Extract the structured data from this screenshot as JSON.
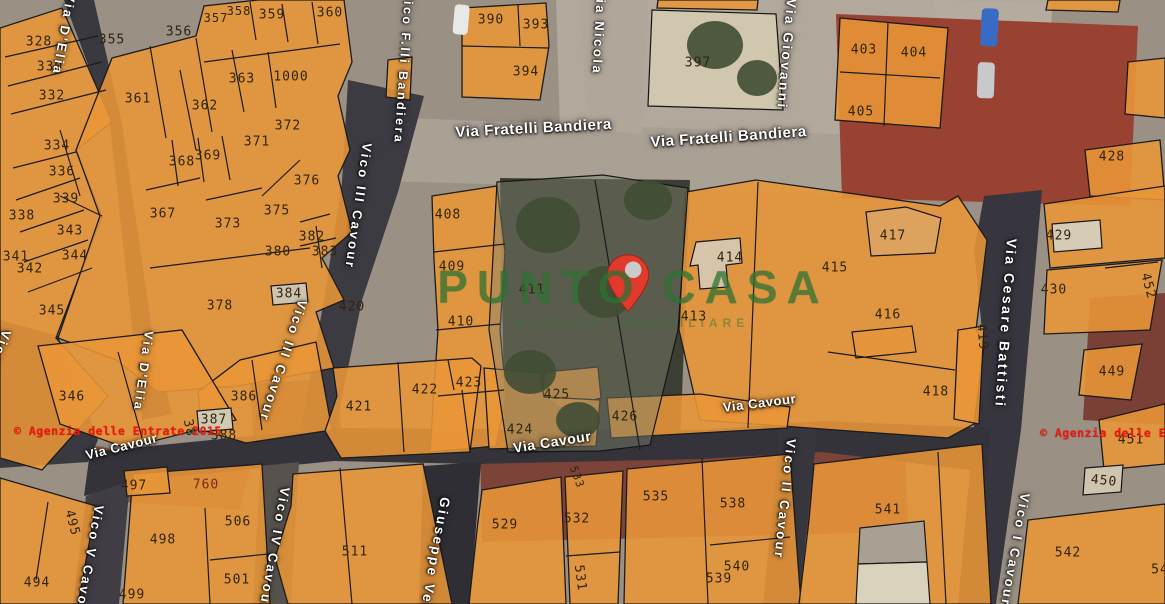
{
  "map": {
    "description": "satellite cadastral map with orange parcel overlay"
  },
  "watermark": {
    "line1": "PUNTO",
    "line2": "CASA",
    "subtitle": "AGENZIA IMMOBILIARE",
    "color": "#307434"
  },
  "marker": {
    "name": "property-location",
    "color": "#df3a2c"
  },
  "copyright_left": "© Agenzia delle Entrate 2015",
  "copyright_right": "© Agenzia delle En",
  "colors": {
    "parcel_fill": "#E99638",
    "parcel_line": "#1b1b1b",
    "street_dark": "#383741",
    "road_light": "#ABA194",
    "label_text": "#30250f",
    "street_text": "#ffffff",
    "copyright": "#f1170c"
  },
  "street_labels": [
    {
      "name": "Via D'Elia",
      "x": 64,
      "y": -8,
      "v": 1,
      "rot": 10,
      "fs": 13
    },
    {
      "name": "Vico F.lli Bandiera",
      "x": 402,
      "y": -10,
      "v": 1,
      "rot": 4,
      "fs": 12.5
    },
    {
      "name": "Via Nicola",
      "x": 594,
      "y": -12,
      "v": 1,
      "rot": 3,
      "fs": 13
    },
    {
      "name": "Via Giovanni",
      "x": 784,
      "y": -2,
      "v": 1,
      "rot": 5,
      "fs": 13.5
    },
    {
      "name": "Via Fratelli Bandiera",
      "x": 455,
      "y": 124,
      "v": 0,
      "rot": -3,
      "fs": 15
    },
    {
      "name": "Via Fratelli Bandiera",
      "x": 650,
      "y": 134,
      "v": 0,
      "rot": -4,
      "fs": 15
    },
    {
      "name": "Vico III Cavour",
      "x": 360,
      "y": 142,
      "v": 1,
      "rot": 8,
      "fs": 13
    },
    {
      "name": "Vico III Cavour",
      "x": 296,
      "y": 298,
      "v": 1,
      "rot": 18,
      "fs": 13
    },
    {
      "name": "Via D'Elia",
      "x": 142,
      "y": 330,
      "v": 1,
      "rot": 8,
      "fs": 12.5
    },
    {
      "name": "Vico VI Cavour",
      "x": 0,
      "y": 328,
      "v": 1,
      "rot": 20,
      "fs": 13
    },
    {
      "name": "Via Cesare Battisti",
      "x": 1004,
      "y": 238,
      "v": 1,
      "rot": 4,
      "fs": 14
    },
    {
      "name": "Via Cavour",
      "x": 84,
      "y": 448,
      "v": 0,
      "rot": -14,
      "fs": 13
    },
    {
      "name": "Via Cavour",
      "x": 512,
      "y": 440,
      "v": 0,
      "rot": -9,
      "fs": 14
    },
    {
      "name": "Via Cavour",
      "x": 722,
      "y": 400,
      "v": 0,
      "rot": -7,
      "fs": 13
    },
    {
      "name": "Vico V Cavour",
      "x": 92,
      "y": 504,
      "v": 1,
      "rot": 10,
      "fs": 13
    },
    {
      "name": "Vico IV Cavour",
      "x": 278,
      "y": 486,
      "v": 1,
      "rot": 10,
      "fs": 13
    },
    {
      "name": "Giuseppe Verdi",
      "x": 438,
      "y": 496,
      "v": 1,
      "rot": 10,
      "fs": 13.5
    },
    {
      "name": "Vico II Cavour",
      "x": 784,
      "y": 438,
      "v": 1,
      "rot": 6,
      "fs": 13
    },
    {
      "name": "Vico I Cavour",
      "x": 1018,
      "y": 492,
      "v": 1,
      "rot": 10,
      "fs": 13
    }
  ],
  "parcel_labels": [
    {
      "n": "328",
      "x": 39,
      "y": 42
    },
    {
      "n": "330",
      "x": 50,
      "y": 67
    },
    {
      "n": "332",
      "x": 52,
      "y": 96
    },
    {
      "n": "334",
      "x": 57,
      "y": 146
    },
    {
      "n": "336",
      "x": 62,
      "y": 172
    },
    {
      "n": "338",
      "x": 22,
      "y": 216
    },
    {
      "n": "339",
      "x": 66,
      "y": 199
    },
    {
      "n": "343",
      "x": 70,
      "y": 231
    },
    {
      "n": "341",
      "x": 16,
      "y": 257
    },
    {
      "n": "344",
      "x": 75,
      "y": 256
    },
    {
      "n": "342",
      "x": 30,
      "y": 269
    },
    {
      "n": "345",
      "x": 52,
      "y": 311
    },
    {
      "n": "346",
      "x": 72,
      "y": 397
    },
    {
      "n": "355",
      "x": 112,
      "y": 40
    },
    {
      "n": "356",
      "x": 179,
      "y": 32
    },
    {
      "n": "357",
      "x": 216,
      "y": 18,
      "fs": 12
    },
    {
      "n": "358",
      "x": 239,
      "y": 11,
      "fs": 12
    },
    {
      "n": "359",
      "x": 272,
      "y": 15
    },
    {
      "n": "360",
      "x": 330,
      "y": 13
    },
    {
      "n": "361",
      "x": 138,
      "y": 99
    },
    {
      "n": "362",
      "x": 205,
      "y": 106
    },
    {
      "n": "363",
      "x": 242,
      "y": 79
    },
    {
      "n": "1000",
      "x": 291,
      "y": 77
    },
    {
      "n": "372",
      "x": 288,
      "y": 126
    },
    {
      "n": "371",
      "x": 257,
      "y": 142
    },
    {
      "n": "368",
      "x": 182,
      "y": 162
    },
    {
      "n": "369",
      "x": 208,
      "y": 156
    },
    {
      "n": "367",
      "x": 163,
      "y": 214
    },
    {
      "n": "373",
      "x": 228,
      "y": 224
    },
    {
      "n": "375",
      "x": 277,
      "y": 211
    },
    {
      "n": "376",
      "x": 307,
      "y": 181
    },
    {
      "n": "380",
      "x": 278,
      "y": 252
    },
    {
      "n": "382",
      "x": 312,
      "y": 237
    },
    {
      "n": "383",
      "x": 325,
      "y": 252
    },
    {
      "n": "384",
      "x": 289,
      "y": 294
    },
    {
      "n": "378",
      "x": 220,
      "y": 306
    },
    {
      "n": "420",
      "x": 352,
      "y": 307
    },
    {
      "n": "386",
      "x": 244,
      "y": 397
    },
    {
      "n": "387",
      "x": 214,
      "y": 420
    },
    {
      "n": "388",
      "x": 224,
      "y": 436
    },
    {
      "n": "38",
      "x": 189,
      "y": 428,
      "rot": 78
    },
    {
      "n": "390",
      "x": 491,
      "y": 20
    },
    {
      "n": "393",
      "x": 536,
      "y": 25
    },
    {
      "n": "394",
      "x": 526,
      "y": 72
    },
    {
      "n": "397",
      "x": 698,
      "y": 63
    },
    {
      "n": "403",
      "x": 864,
      "y": 50
    },
    {
      "n": "404",
      "x": 914,
      "y": 53
    },
    {
      "n": "405",
      "x": 861,
      "y": 112
    },
    {
      "n": "428",
      "x": 1112,
      "y": 157
    },
    {
      "n": "408",
      "x": 448,
      "y": 215
    },
    {
      "n": "409",
      "x": 452,
      "y": 267
    },
    {
      "n": "410",
      "x": 461,
      "y": 322
    },
    {
      "n": "411",
      "x": 532,
      "y": 290
    },
    {
      "n": "413",
      "x": 694,
      "y": 317
    },
    {
      "n": "414",
      "x": 730,
      "y": 258
    },
    {
      "n": "415",
      "x": 835,
      "y": 268
    },
    {
      "n": "416",
      "x": 888,
      "y": 315
    },
    {
      "n": "417",
      "x": 893,
      "y": 236
    },
    {
      "n": "418",
      "x": 936,
      "y": 392
    },
    {
      "n": "419",
      "x": 982,
      "y": 337,
      "rot": 85
    },
    {
      "n": "429",
      "x": 1059,
      "y": 236
    },
    {
      "n": "430",
      "x": 1054,
      "y": 290
    },
    {
      "n": "449",
      "x": 1112,
      "y": 372
    },
    {
      "n": "452",
      "x": 1148,
      "y": 286,
      "rot": 75
    },
    {
      "n": "451",
      "x": 1131,
      "y": 440
    },
    {
      "n": "450",
      "x": 1104,
      "y": 481,
      "rot": 6
    },
    {
      "n": "421",
      "x": 359,
      "y": 407
    },
    {
      "n": "422",
      "x": 425,
      "y": 390
    },
    {
      "n": "423",
      "x": 469,
      "y": 383
    },
    {
      "n": "424",
      "x": 520,
      "y": 430
    },
    {
      "n": "425",
      "x": 557,
      "y": 395
    },
    {
      "n": "426",
      "x": 625,
      "y": 417
    },
    {
      "n": "494",
      "x": 37,
      "y": 583
    },
    {
      "n": "495",
      "x": 72,
      "y": 523,
      "rot": 75
    },
    {
      "n": "497",
      "x": 134,
      "y": 486
    },
    {
      "n": "498",
      "x": 163,
      "y": 540
    },
    {
      "n": "499",
      "x": 132,
      "y": 595
    },
    {
      "n": "501",
      "x": 237,
      "y": 580
    },
    {
      "n": "506",
      "x": 238,
      "y": 522
    },
    {
      "n": "511",
      "x": 355,
      "y": 552
    },
    {
      "n": "760",
      "x": 206,
      "y": 485,
      "c": "#7a2a1a"
    },
    {
      "n": "529",
      "x": 505,
      "y": 525
    },
    {
      "n": "531",
      "x": 580,
      "y": 578,
      "rot": 82
    },
    {
      "n": "532",
      "x": 577,
      "y": 519
    },
    {
      "n": "533",
      "x": 577,
      "y": 477,
      "rot": 70,
      "fs": 11
    },
    {
      "n": "535",
      "x": 656,
      "y": 497
    },
    {
      "n": "538",
      "x": 733,
      "y": 504
    },
    {
      "n": "539",
      "x": 719,
      "y": 579
    },
    {
      "n": "540",
      "x": 737,
      "y": 567
    },
    {
      "n": "541",
      "x": 888,
      "y": 510
    },
    {
      "n": "542",
      "x": 1068,
      "y": 553
    },
    {
      "n": "54",
      "x": 1160,
      "y": 570
    }
  ]
}
